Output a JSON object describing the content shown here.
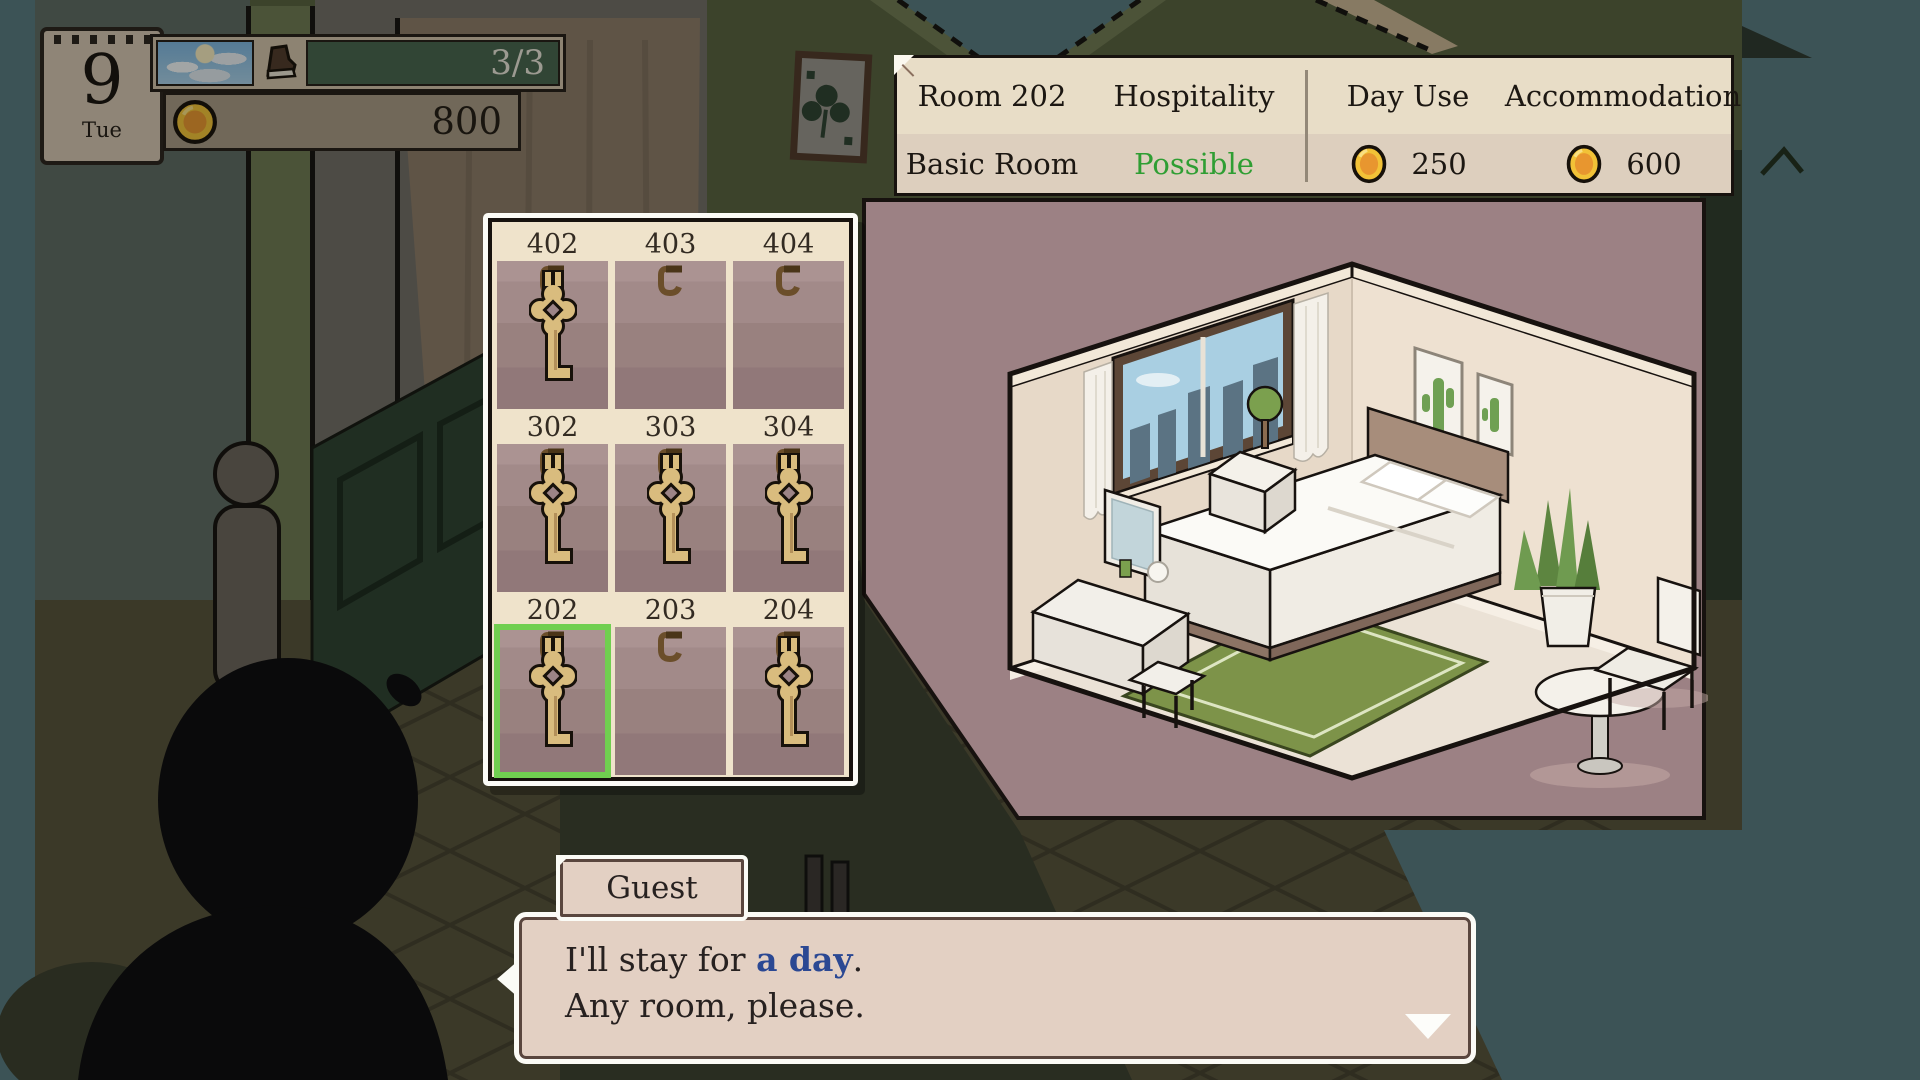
{
  "hud": {
    "calendar": {
      "day": "9",
      "weekday": "Tue"
    },
    "weather_icon": "partly-cloudy-sky",
    "occupancy": {
      "icon": "shoe-icon",
      "value": "3/3"
    },
    "money": {
      "icon": "coin-icon",
      "value": "800"
    }
  },
  "room_info": {
    "room_name": "Room 202",
    "hospitality_label": "Hospitality",
    "day_use_label": "Day Use",
    "accommodation_label": "Accommodation",
    "room_type": "Basic Room",
    "hospitality_value": "Possible",
    "day_use_price": "250",
    "accommodation_price": "600"
  },
  "key_rack": {
    "rows": [
      {
        "slots": [
          {
            "number": "402",
            "has_key": true,
            "selected": false
          },
          {
            "number": "403",
            "has_key": false,
            "selected": false
          },
          {
            "number": "404",
            "has_key": false,
            "selected": false
          }
        ]
      },
      {
        "slots": [
          {
            "number": "302",
            "has_key": true,
            "selected": false
          },
          {
            "number": "303",
            "has_key": true,
            "selected": false
          },
          {
            "number": "304",
            "has_key": true,
            "selected": false
          }
        ]
      },
      {
        "slots": [
          {
            "number": "202",
            "has_key": true,
            "selected": true
          },
          {
            "number": "203",
            "has_key": false,
            "selected": false
          },
          {
            "number": "204",
            "has_key": true,
            "selected": false
          }
        ]
      }
    ]
  },
  "dialogue": {
    "speaker": "Guest",
    "line1_prefix": "I'll stay for ",
    "line1_highlight": "a day",
    "line1_suffix": ".",
    "line2": "Any room, please."
  },
  "colors": {
    "possible_green": "#2f9e33",
    "selection_green": "#70cf50",
    "highlight_blue": "#2b4893",
    "coin_gold": "#f2c237",
    "preview_backdrop": "#9c8184",
    "dialogue_bg": "#e3d0c3"
  }
}
